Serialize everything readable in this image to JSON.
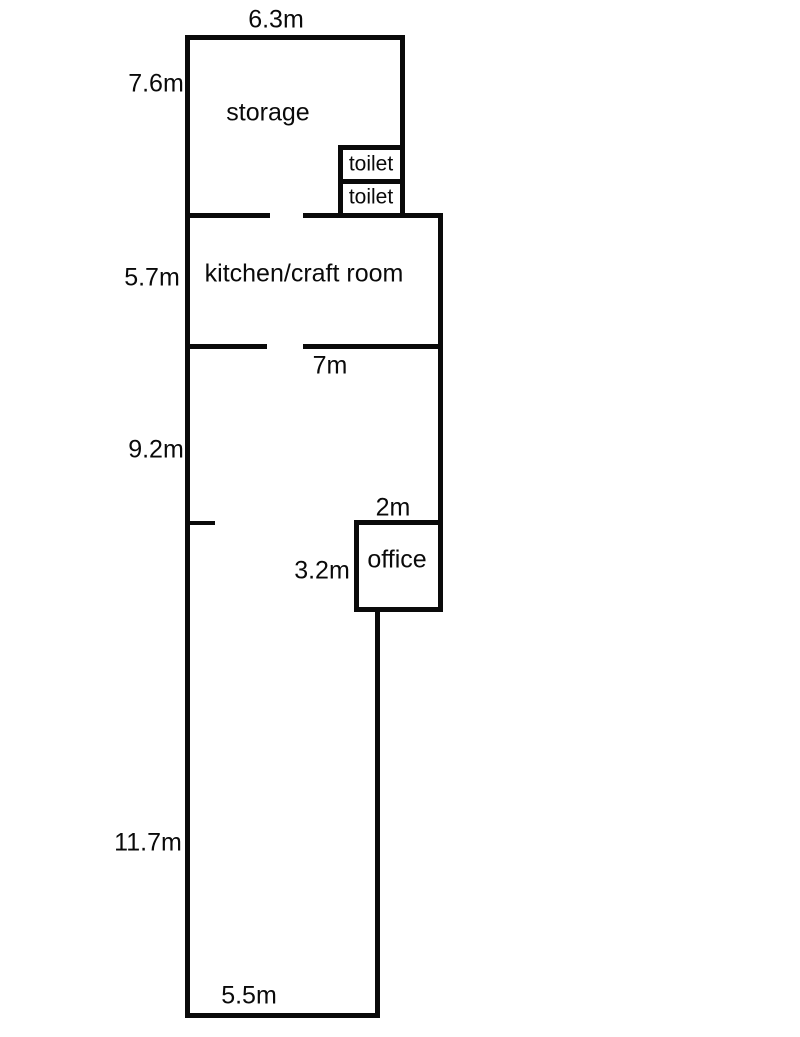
{
  "page": {
    "background": "#ffffff",
    "wall_color": "#0a0a0a",
    "text_color": "#0a0a0a"
  },
  "floorplan": {
    "type": "floor-plan",
    "rooms": [
      {
        "label": "storage",
        "width_label": "6.3m",
        "height_label": "7.6m"
      },
      {
        "label": "toilet"
      },
      {
        "label": "toilet"
      },
      {
        "label": "kitchen/craft room",
        "height_label": "5.7m",
        "width_label": "7m"
      },
      {
        "label": "office",
        "width_label": "2m",
        "height_label": "3.2m"
      }
    ],
    "other_dimensions": [
      "9.2m",
      "11.7m",
      "5.5m"
    ]
  },
  "walls": [
    {
      "id": "outer-top-wall",
      "x": 185,
      "y": 35,
      "w": 220,
      "h": 5
    },
    {
      "id": "outer-left-wall",
      "x": 185,
      "y": 35,
      "w": 5,
      "h": 983
    },
    {
      "id": "storage-right-wall",
      "x": 400,
      "y": 35,
      "w": 5,
      "h": 183
    },
    {
      "id": "toilet-top-wall",
      "x": 338,
      "y": 145,
      "w": 67,
      "h": 5
    },
    {
      "id": "toilet-left-wall",
      "x": 338,
      "y": 145,
      "w": 5,
      "h": 73
    },
    {
      "id": "toilet-divider-wall",
      "x": 338,
      "y": 179,
      "w": 67,
      "h": 5
    },
    {
      "id": "storage-kitchen-wall-left",
      "x": 185,
      "y": 213,
      "w": 85,
      "h": 5
    },
    {
      "id": "storage-kitchen-wall-right",
      "x": 303,
      "y": 213,
      "w": 140,
      "h": 5
    },
    {
      "id": "outer-right-wall-upper",
      "x": 438,
      "y": 213,
      "w": 5,
      "h": 399
    },
    {
      "id": "kitchen-bottom-wall-left",
      "x": 185,
      "y": 344,
      "w": 82,
      "h": 5
    },
    {
      "id": "kitchen-bottom-wall-right",
      "x": 303,
      "y": 344,
      "w": 140,
      "h": 5
    },
    {
      "id": "left-stub-wall",
      "x": 190,
      "y": 521,
      "w": 25,
      "h": 4
    },
    {
      "id": "office-top-wall",
      "x": 354,
      "y": 520,
      "w": 89,
      "h": 5
    },
    {
      "id": "office-left-wall",
      "x": 354,
      "y": 520,
      "w": 5,
      "h": 92
    },
    {
      "id": "office-bottom-wall",
      "x": 354,
      "y": 607,
      "w": 89,
      "h": 5
    },
    {
      "id": "outer-right-wall-lower",
      "x": 375,
      "y": 607,
      "w": 5,
      "h": 411
    },
    {
      "id": "outer-bottom-wall",
      "x": 185,
      "y": 1013,
      "w": 195,
      "h": 5
    }
  ],
  "labels": [
    {
      "id": "dim-storage-width",
      "text": "6.3m",
      "x": 276,
      "y": 20,
      "kind": "dimension"
    },
    {
      "id": "dim-storage-height",
      "text": "7.6m",
      "x": 156,
      "y": 84,
      "kind": "dimension"
    },
    {
      "id": "room-storage",
      "text": "storage",
      "x": 268,
      "y": 113,
      "kind": "room"
    },
    {
      "id": "room-toilet-upper",
      "text": "toilet",
      "x": 371,
      "y": 164,
      "kind": "room-small"
    },
    {
      "id": "room-toilet-lower",
      "text": "toilet",
      "x": 371,
      "y": 197,
      "kind": "room-small"
    },
    {
      "id": "dim-kitchen-height",
      "text": "5.7m",
      "x": 152,
      "y": 278,
      "kind": "dimension"
    },
    {
      "id": "room-kitchen",
      "text": "kitchen/craft room",
      "x": 304,
      "y": 274,
      "kind": "room"
    },
    {
      "id": "dim-kitchen-width",
      "text": "7m",
      "x": 330,
      "y": 366,
      "kind": "dimension"
    },
    {
      "id": "dim-middle-height",
      "text": "9.2m",
      "x": 156,
      "y": 450,
      "kind": "dimension"
    },
    {
      "id": "dim-office-width",
      "text": "2m",
      "x": 393,
      "y": 508,
      "kind": "dimension"
    },
    {
      "id": "dim-office-height",
      "text": "3.2m",
      "x": 322,
      "y": 571,
      "kind": "dimension"
    },
    {
      "id": "room-office",
      "text": "office",
      "x": 397,
      "y": 560,
      "kind": "room"
    },
    {
      "id": "dim-lower-height",
      "text": "11.7m",
      "x": 148,
      "y": 843,
      "kind": "dimension"
    },
    {
      "id": "dim-bottom-width",
      "text": "5.5m",
      "x": 249,
      "y": 996,
      "kind": "dimension"
    }
  ]
}
